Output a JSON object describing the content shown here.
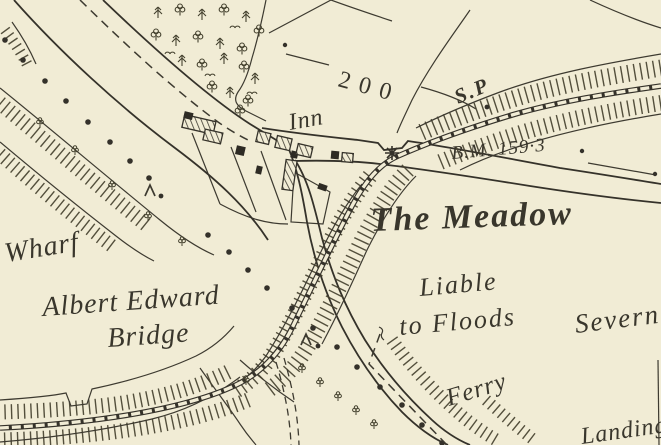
{
  "map": {
    "style": "historic-ordnance-survey-extract",
    "colors": {
      "paper": "#f1ecd5",
      "ink": "#3d3a30"
    },
    "labels": {
      "inn": "Inn",
      "contour_200": "200",
      "signal_post": "S.P",
      "bench_mark": "B.M. 159·3",
      "meadow": "The Meadow",
      "liable_line1": "Liable",
      "liable_line2": "to Floods",
      "river": "Severn",
      "wharf": "Wharf",
      "bridge_line1": "Albert Edward",
      "bridge_line2": "Bridge",
      "ferry": "Ferry",
      "landing": "Landing"
    }
  }
}
